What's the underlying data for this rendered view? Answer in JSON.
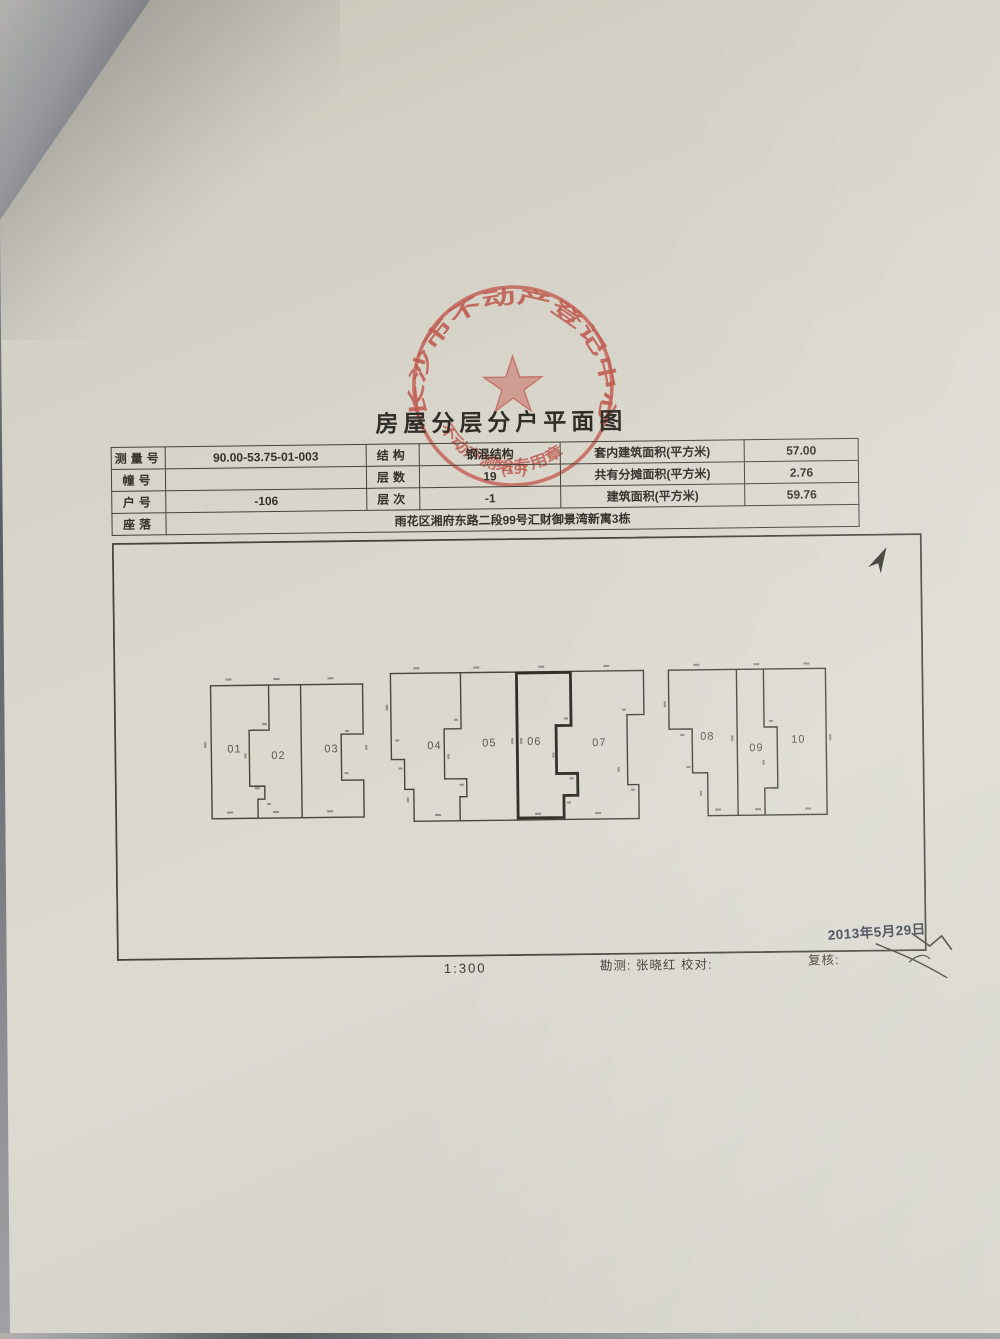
{
  "title": "房屋分层分户平面图",
  "stamp": {
    "arc_text": "长沙市不动产登记中心",
    "sub_text": "不动产测绘专用章",
    "number": "(19)"
  },
  "info_table": {
    "rows": [
      [
        "测量号",
        "90.00-53.75-01-003",
        "结构",
        "钢混结构",
        "套内建筑面积(平方米)",
        "57.00"
      ],
      [
        "幢号",
        "",
        "层数",
        "19",
        "共有分摊面积(平方米)",
        "2.76"
      ],
      [
        "户号",
        "-106",
        "层次",
        "-1",
        "建筑面积(平方米)",
        "59.76"
      ],
      [
        "座落",
        "雨花区湘府东路二段99号汇财御景湾新寓3栋"
      ]
    ]
  },
  "plan": {
    "units": [
      "01",
      "02",
      "03",
      "04",
      "05",
      "06",
      "07",
      "08",
      "09",
      "10"
    ],
    "scale": "1:300",
    "survey_line": "勘测: 张晓红   校对:",
    "review_line": "复核:",
    "date": "2013年5月29日"
  }
}
